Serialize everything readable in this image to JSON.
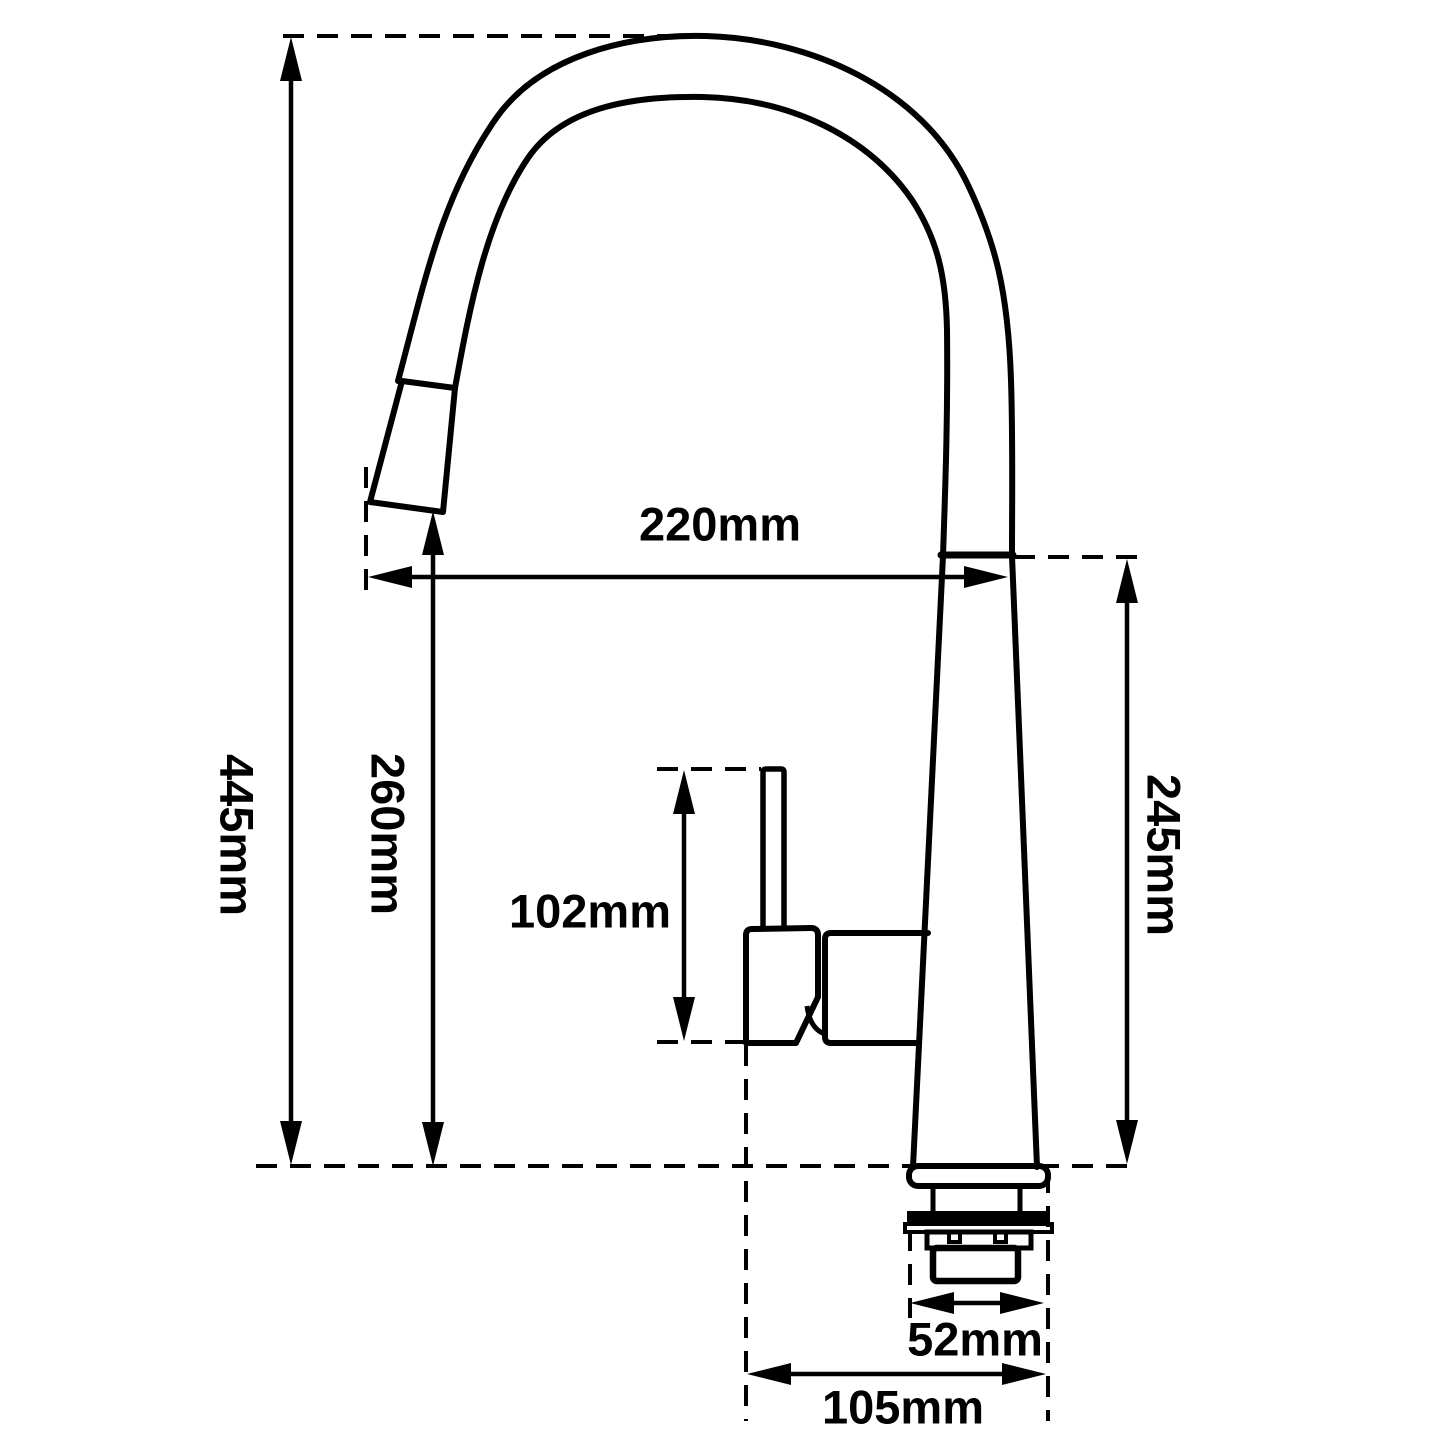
{
  "meta": {
    "type": "technical-dimension-drawing",
    "subject": "pull-out gooseneck kitchen mixer tap, side elevation",
    "ink_color": "#000000",
    "background_color": "#ffffff"
  },
  "dimensions": {
    "overall_height": "445mm",
    "spout_tip_height": "260mm",
    "spout_reach": "220mm",
    "body_height": "245mm",
    "handle_height": "102mm",
    "thread_diameter": "52mm",
    "base_spread": "105mm"
  }
}
